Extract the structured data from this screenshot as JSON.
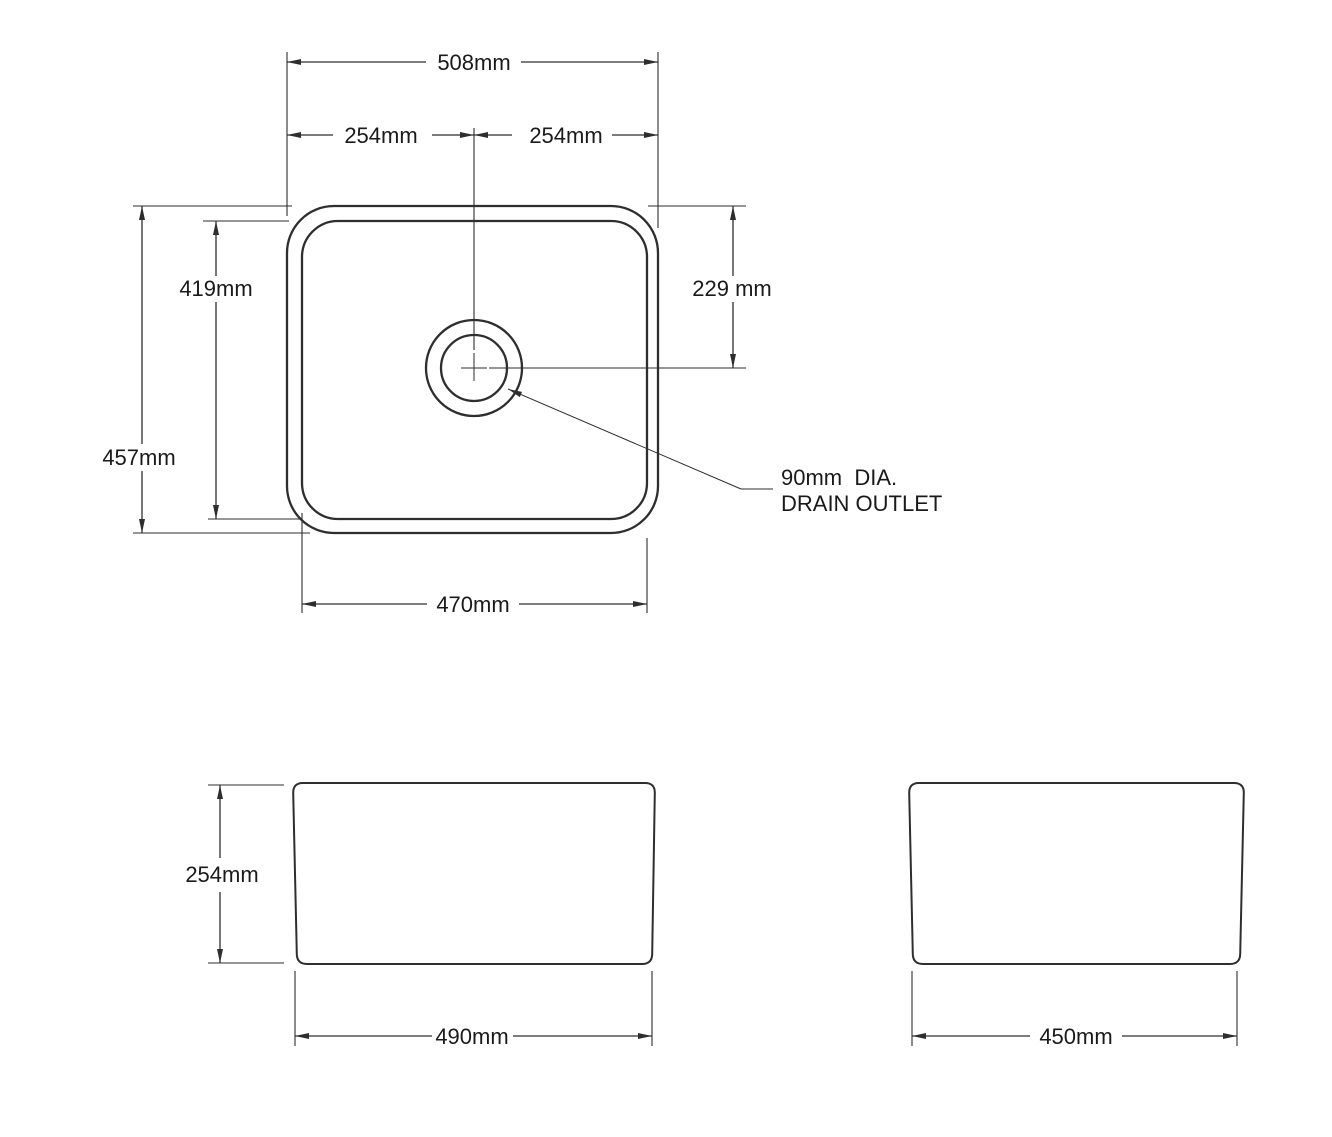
{
  "colors": {
    "line": "#2e2e2e",
    "text": "#1a1a1a",
    "background": "#ffffff"
  },
  "top_view": {
    "overall_width": "508mm",
    "center_to_left": "254mm",
    "center_to_right": "254mm",
    "inner_length": "419mm",
    "overall_length": "457mm",
    "drain_from_edge": "229 mm",
    "inner_width": "470mm",
    "drain_note_line1": "90mm  DIA.",
    "drain_note_line2": "DRAIN OUTLET"
  },
  "front_view": {
    "height": "254mm",
    "width": "490mm"
  },
  "side_view": {
    "width": "450mm"
  }
}
